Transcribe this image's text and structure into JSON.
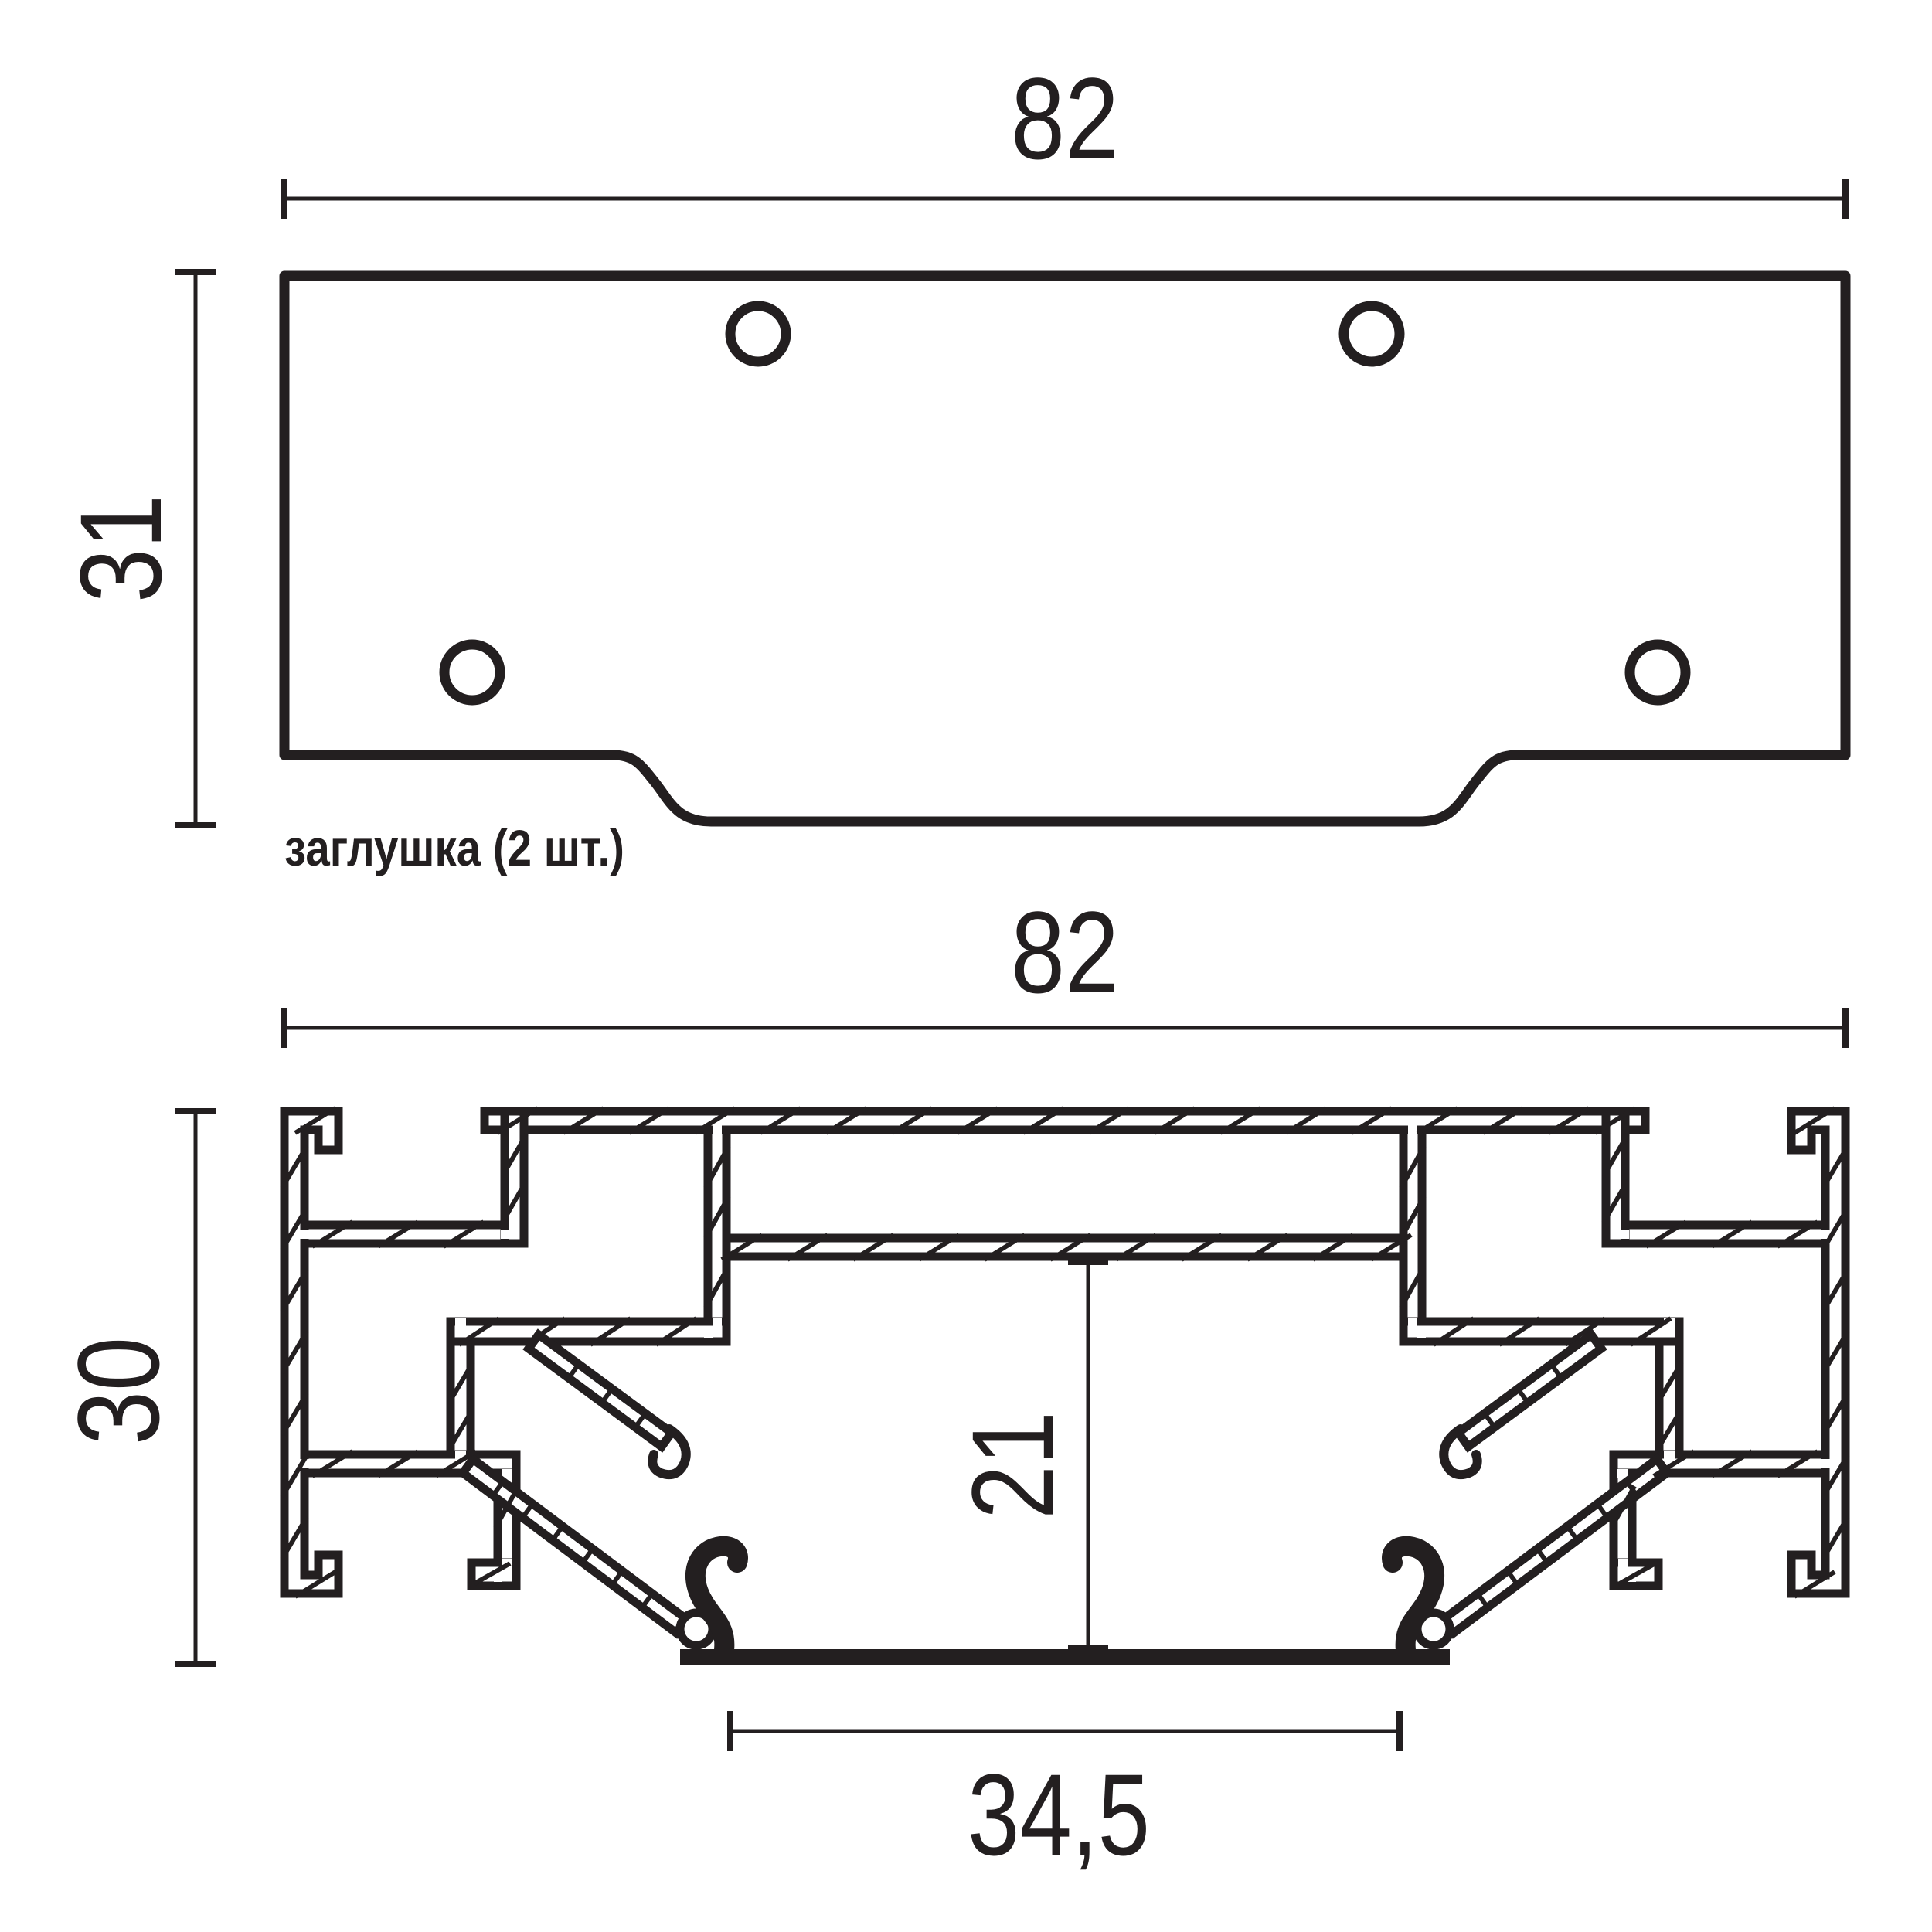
{
  "page": {
    "background": "#ffffff",
    "ink_color": "#231f20",
    "type": "technical drawing, end cap and aluminium profile cross-section"
  },
  "top_view": {
    "name": "end cap top view",
    "label": "заглушка (2 шт.)",
    "width_dim": "82",
    "height_dim": "31",
    "holes_count": "4"
  },
  "section_view": {
    "name": "profile cross-section view",
    "width_dim": "82",
    "height_dim": "30",
    "inner_height_dim": "21",
    "opening_width_dim": "34,5"
  }
}
